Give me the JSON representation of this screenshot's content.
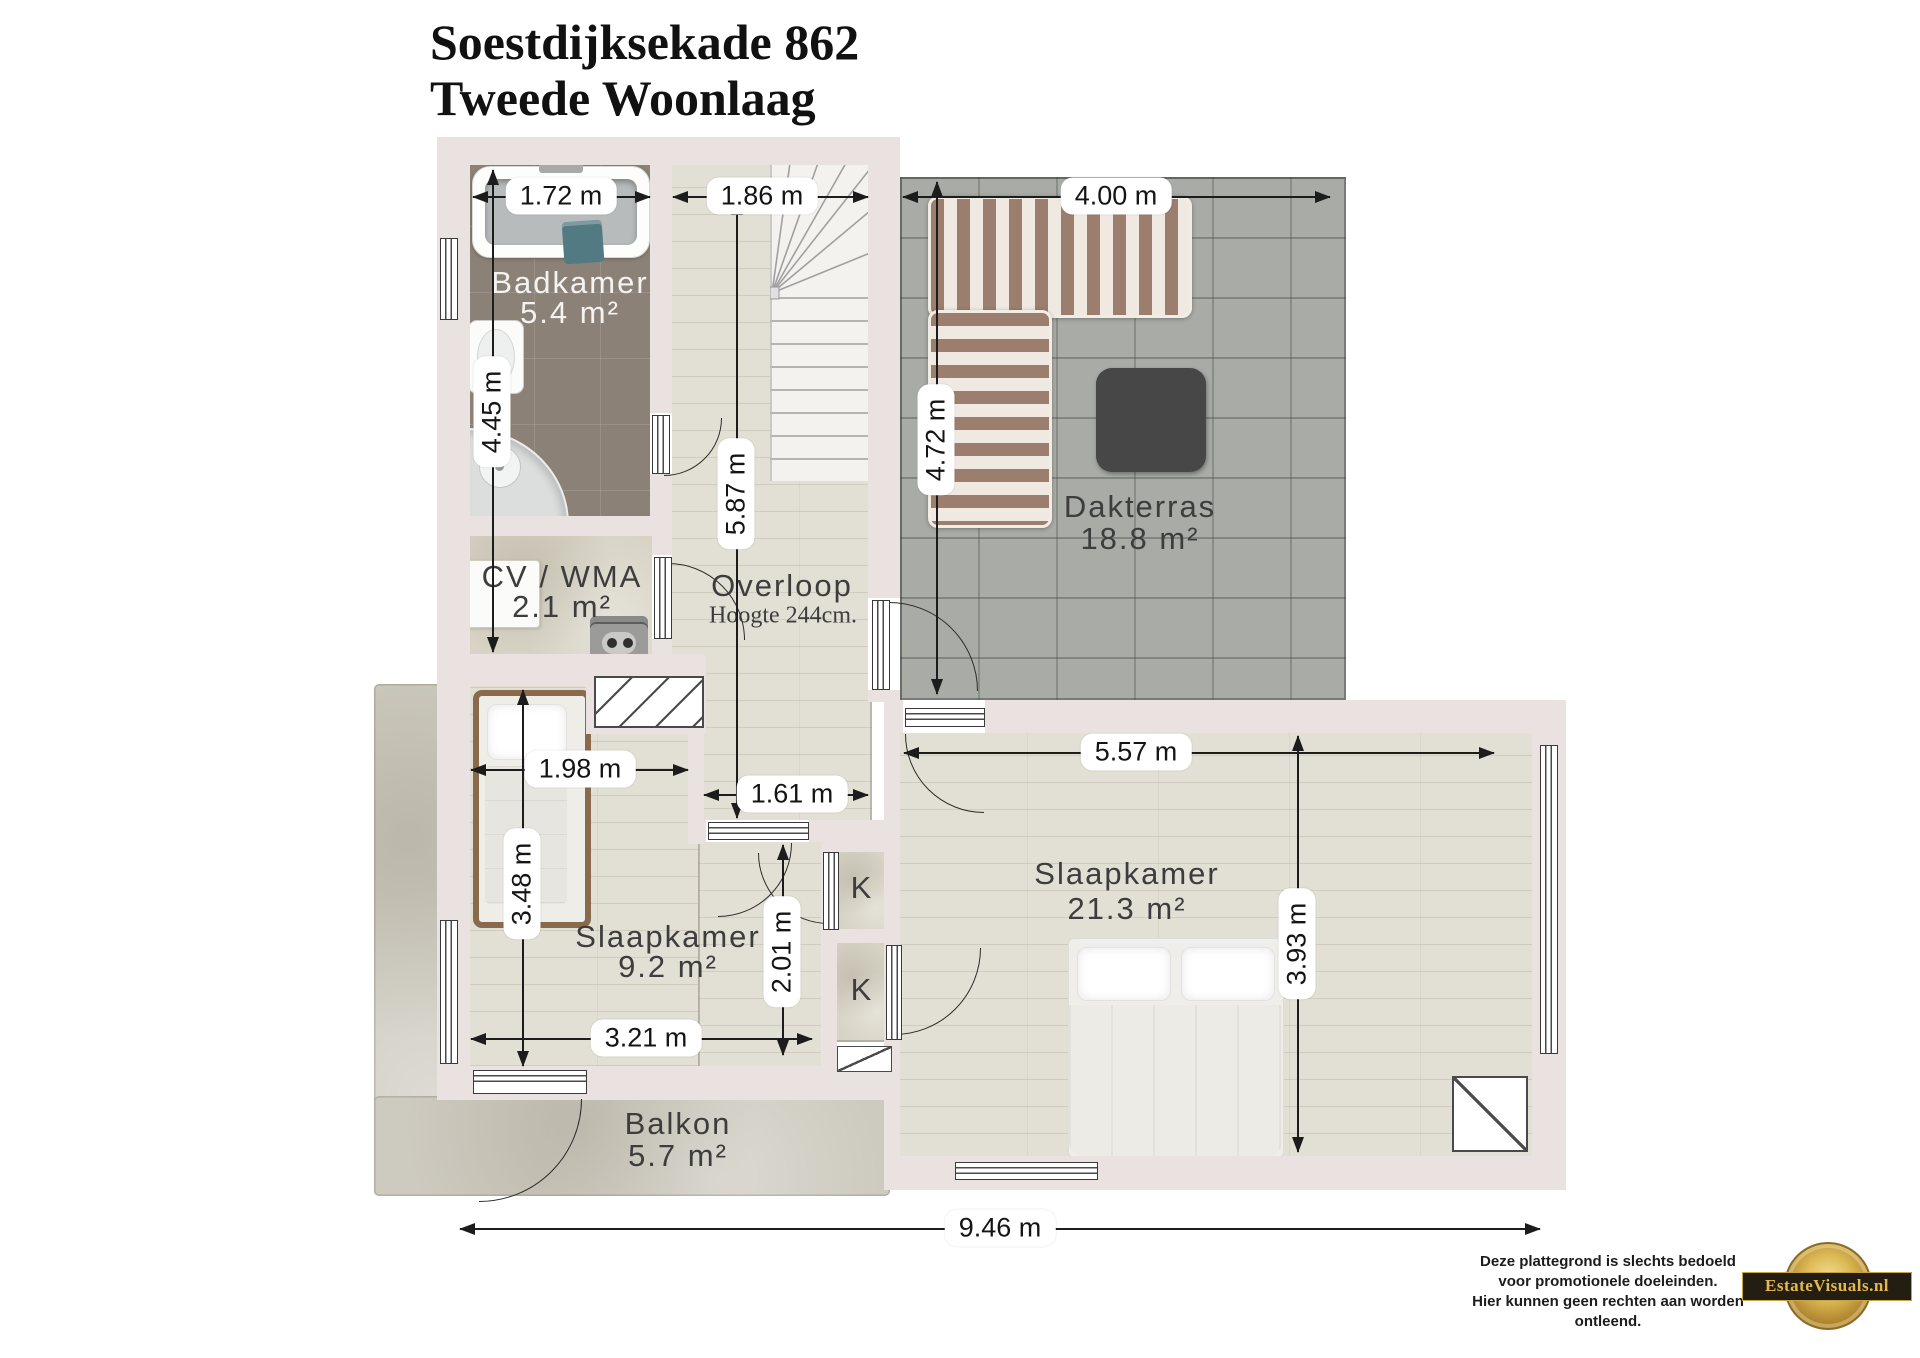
{
  "title": {
    "line1": "Soestdijksekade 862",
    "line2": "Tweede Woonlaag"
  },
  "rooms": {
    "badkamer": {
      "name": "Badkamer",
      "area": "5.4 m²"
    },
    "cv_wma": {
      "name": "CV / WMA",
      "area": "2.1 m²"
    },
    "overloop": {
      "name": "Overloop",
      "height_note": "Hoogte 244cm."
    },
    "dakterras": {
      "name": "Dakterras",
      "area": "18.8 m²"
    },
    "slaapkamer_klein": {
      "name": "Slaapkamer",
      "area": "9.2 m²"
    },
    "slaapkamer_groot": {
      "name": "Slaapkamer",
      "area": "21.3 m²"
    },
    "balkon": {
      "name": "Balkon",
      "area": "5.7 m²"
    },
    "kast_1": {
      "label": "K"
    },
    "kast_2": {
      "label": "K"
    }
  },
  "dimensions": {
    "badkamer_breedte": "1.72 m",
    "hal_breedte": "1.86 m",
    "dakterras_breedte": "4.00 m",
    "badkamer_cv_hoogte": "4.45 m",
    "overloop_hoogte": "5.87 m",
    "dakterras_hoogte": "4.72 m",
    "slaapkamer_klein_breedte_boven": "1.98 m",
    "slaapkamer_klein_hoogte": "3.48 m",
    "overloop_onder_breedte": "1.61 m",
    "slaapkamer_groot_breedte": "5.57 m",
    "slaapkamer_groot_hoogte": "3.93 m",
    "kast_hoogte": "2.01 m",
    "slaapkamer_klein_breedte_onder": "3.21 m",
    "totaal_breedte": "9.46 m"
  },
  "footer": {
    "disclaimer_line1": "Deze plattegrond is slechts bedoeld",
    "disclaimer_line2": "voor promotionele doeleinden.",
    "disclaimer_line3": "Hier kunnen geen rechten aan worden ontleend.",
    "logo_text": "EstateVisuals.nl"
  },
  "colors": {
    "wall": "#eae2e0",
    "wood_floor": "#e2dfd4",
    "tile_floor": "#8b8177",
    "paver_floor": "#a8aba6",
    "concrete_floor": "#d7d3c5",
    "balkon_floor": "#cdcabf",
    "dimension_pill_bg": "#ffffff",
    "dimension_text": "#141414",
    "label_text": "#3d3d3d",
    "label_text_light": "#f4f3f1",
    "sofa_stripe": "#9b7e6d",
    "table": "#474747",
    "logo_gold": "#e3b94f",
    "logo_band": "#241e12"
  }
}
